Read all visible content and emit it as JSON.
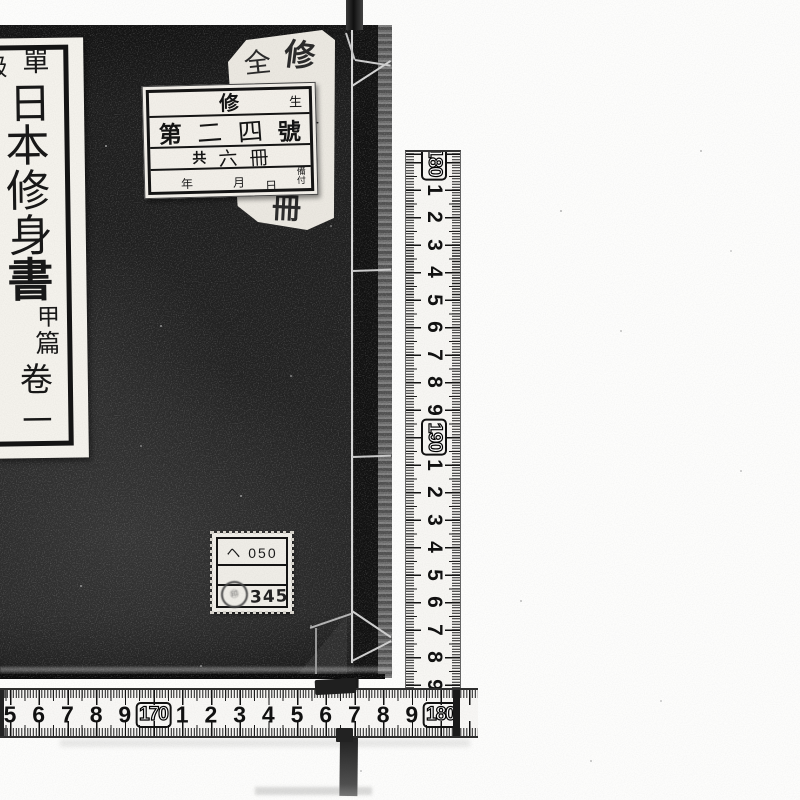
{
  "book": {
    "cover_color": "#1d1d1d",
    "spine_label": {
      "full_title": "單級日本修身書 甲篇 卷一",
      "header": [
        "單",
        "級"
      ],
      "title": [
        "日",
        "本",
        "修",
        "身",
        "書"
      ],
      "edition": [
        "甲",
        "篇"
      ],
      "volume": [
        "卷",
        "一"
      ]
    },
    "register_label": {
      "row1": {
        "center": "修",
        "right": "生"
      },
      "row2": [
        "第",
        "二",
        "四",
        "號"
      ],
      "row3": [
        "共",
        "六",
        "冊"
      ],
      "row4": {
        "year": "年",
        "month": "月",
        "day": "日",
        "note_top": "備",
        "note_bottom": "付"
      }
    },
    "handwritten_note": {
      "top_left": "全",
      "top_right": "修",
      "middle": "六",
      "bottom": "冊"
    },
    "call_number_label": {
      "line1": "ヘ 050",
      "line3": "345"
    }
  },
  "rulers": {
    "vertical": {
      "labels": [
        "180",
        "1",
        "2",
        "3",
        "4",
        "5",
        "6",
        "7",
        "8",
        "9",
        "190",
        "1",
        "2",
        "3",
        "4",
        "5",
        "6",
        "7",
        "8",
        "9"
      ],
      "start_y": 160,
      "step": 27.5
    },
    "horizontal": {
      "labels": [
        "5",
        "6",
        "7",
        "8",
        "9",
        "170",
        "1",
        "2",
        "3",
        "4",
        "5",
        "6",
        "7",
        "8",
        "9",
        "180"
      ],
      "start_x": 10,
      "step": 28.7
    }
  }
}
